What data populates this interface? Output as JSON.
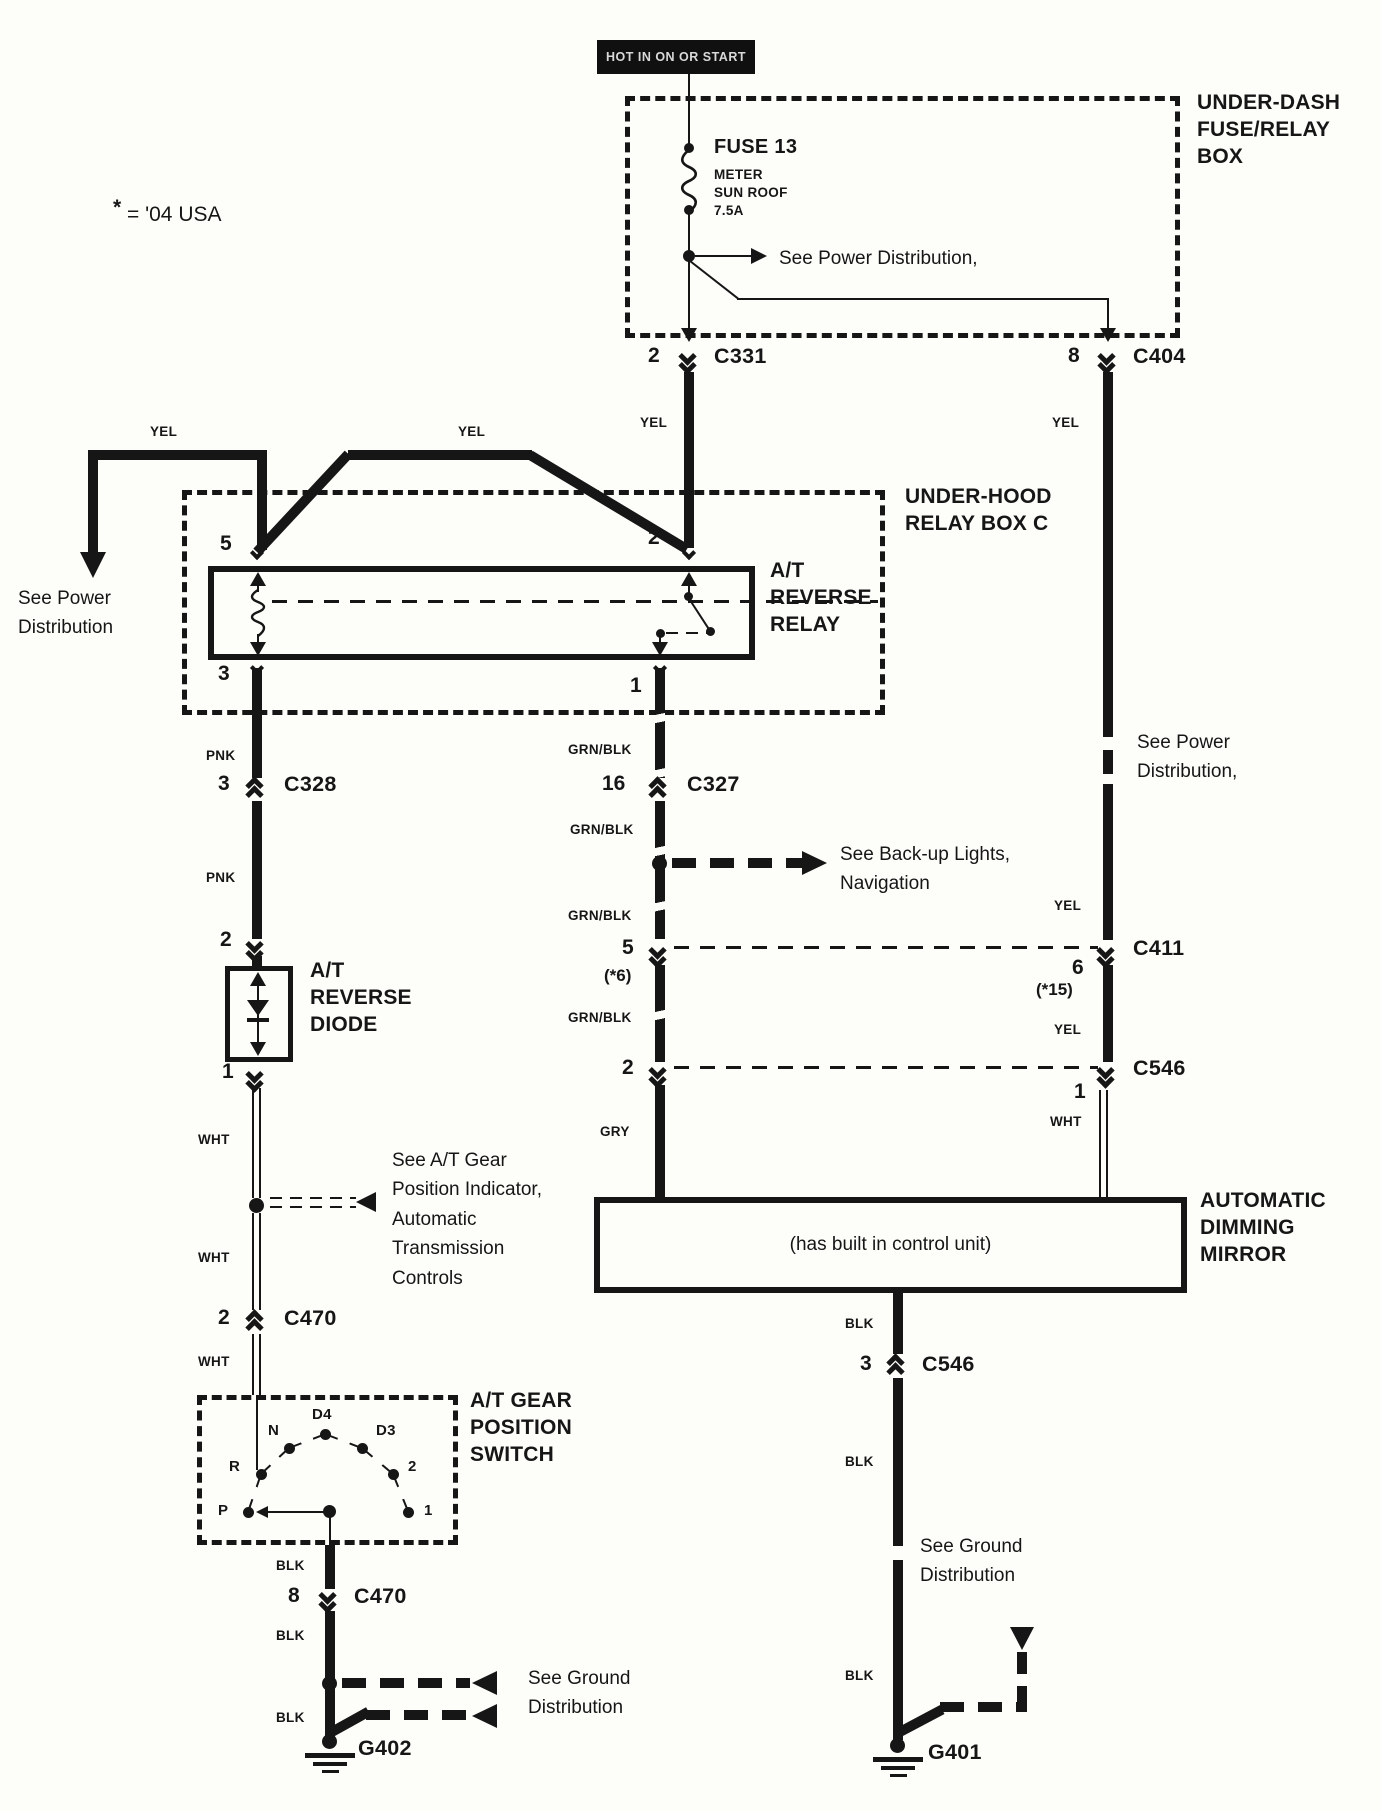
{
  "note": {
    "star": "*",
    "text": " = '04 USA"
  },
  "power_source_label": "HOT IN ON OR START",
  "wire_colors": {
    "yel": "YEL",
    "pnk": "PNK",
    "grn_blk": "GRN/BLK",
    "wht": "WHT",
    "blk": "BLK",
    "gry": "GRY"
  },
  "under_dash_box": {
    "label": "UNDER-DASH\nFUSE/RELAY\nBOX",
    "fuse_name": "FUSE 13",
    "fuse_detail": "METER\nSUN ROOF\n7.5A",
    "see_power": "See Power Distribution,"
  },
  "under_hood_box": {
    "label": "UNDER-HOOD\nRELAY BOX C",
    "relay_label": "A/T\nREVERSE\nRELAY",
    "pin_5": "5",
    "pin_2": "2",
    "pin_3": "3",
    "pin_1": "1"
  },
  "left_branch": {
    "see_power": "See Power\nDistribution"
  },
  "right_branch": {
    "see_power": "See Power\nDistribution,"
  },
  "backup_branch": "See Back-up Lights,\nNavigation",
  "gear_indicator_branch": "See A/T Gear\nPosition Indicator,\nAutomatic\nTransmission\nControls",
  "ground_branch_left": "See Ground\nDistribution",
  "ground_branch_right": "See Ground\nDistribution",
  "connectors": {
    "c331": {
      "pin": "2",
      "name": "C331"
    },
    "c404": {
      "pin": "8",
      "name": "C404"
    },
    "c328": {
      "pin": "3",
      "name": "C328"
    },
    "c327": {
      "pin": "16",
      "name": "C327"
    },
    "inline_5": {
      "pin": "5",
      "note": "(*6)"
    },
    "inline_2": {
      "pin": "2"
    },
    "c411": {
      "pin": "6",
      "name": "C411",
      "note": "(*15)"
    },
    "c546_right": {
      "pin": "1",
      "name": "C546"
    },
    "diode_top": {
      "pin": "2"
    },
    "diode_bottom": {
      "pin": "1"
    },
    "c470_upper": {
      "pin": "2",
      "name": "C470"
    },
    "c470_lower": {
      "pin": "8",
      "name": "C470"
    },
    "c546_bottom": {
      "pin": "3",
      "name": "C546"
    }
  },
  "diode": {
    "label": "A/T\nREVERSE\nDIODE"
  },
  "gear_switch": {
    "label": "A/T GEAR\nPOSITION\nSWITCH",
    "positions": [
      "P",
      "R",
      "N",
      "D4",
      "D3",
      "2",
      "1"
    ]
  },
  "mirror": {
    "inner_note": "(has built in control unit)",
    "label": "AUTOMATIC\nDIMMING\nMIRROR"
  },
  "grounds": {
    "g402": "G402",
    "g401": "G401"
  }
}
